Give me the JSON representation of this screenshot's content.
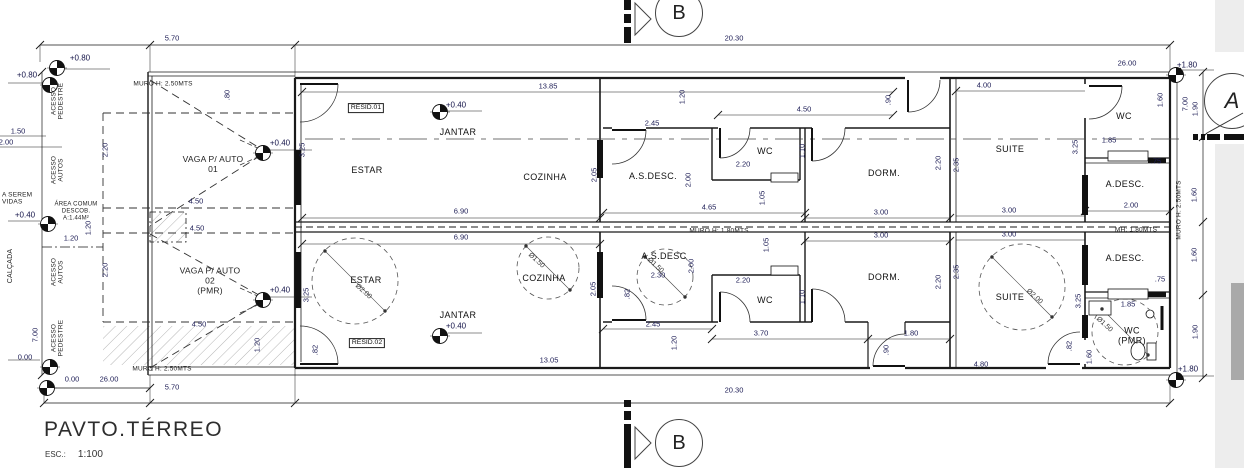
{
  "title_block": {
    "title": "PAVTO.TÉRREO",
    "scale_label": "ESC.:",
    "scale_value": "1:100"
  },
  "section_markers": {
    "top": "B",
    "bottom": "B",
    "side": "A"
  },
  "labels": [
    {
      "t": "ESTAR",
      "x": 367,
      "y": 170,
      "cls": "room"
    },
    {
      "t": "JANTAR",
      "x": 458,
      "y": 132,
      "cls": "room"
    },
    {
      "t": "COZINHA",
      "x": 545,
      "y": 177,
      "cls": "room"
    },
    {
      "t": "A.S.DESC.",
      "x": 653,
      "y": 176,
      "cls": "room"
    },
    {
      "t": "WC",
      "x": 765,
      "y": 151,
      "cls": "room"
    },
    {
      "t": "DORM.",
      "x": 884,
      "y": 173,
      "cls": "room"
    },
    {
      "t": "SUITE",
      "x": 1010,
      "y": 149,
      "cls": "room"
    },
    {
      "t": "WC",
      "x": 1124,
      "y": 116,
      "cls": "room"
    },
    {
      "t": "A.DESC.",
      "x": 1125,
      "y": 184,
      "cls": "room"
    },
    {
      "t": "ESTAR",
      "x": 366,
      "y": 280,
      "cls": "room"
    },
    {
      "t": "JANTAR",
      "x": 458,
      "y": 315,
      "cls": "room"
    },
    {
      "t": "COZINHA",
      "x": 544,
      "y": 278,
      "cls": "room"
    },
    {
      "t": "A.S.DESC",
      "x": 664,
      "y": 256,
      "cls": "room"
    },
    {
      "t": "WC",
      "x": 765,
      "y": 300,
      "cls": "room"
    },
    {
      "t": "DORM.",
      "x": 884,
      "y": 277,
      "cls": "room"
    },
    {
      "t": "SUITE",
      "x": 1010,
      "y": 297,
      "cls": "room"
    },
    {
      "t": "A.DESC.",
      "x": 1125,
      "y": 258,
      "cls": "room"
    },
    {
      "t": "WC\n(PMR)",
      "x": 1132,
      "y": 336,
      "cls": "room"
    },
    {
      "t": "RESID.01",
      "x": 366,
      "y": 108,
      "cls": "boxed",
      "n": "resid-01-tag"
    },
    {
      "t": "RESID.02",
      "x": 367,
      "y": 343,
      "cls": "boxed",
      "n": "resid-02-tag"
    },
    {
      "t": "5.70",
      "x": 172,
      "y": 39
    },
    {
      "t": "20.30",
      "x": 734,
      "y": 39
    },
    {
      "t": "13.85",
      "x": 548,
      "y": 87
    },
    {
      "t": "4.50",
      "x": 804,
      "y": 110
    },
    {
      "t": "4.00",
      "x": 984,
      "y": 86
    },
    {
      "t": "26.00",
      "x": 1127,
      "y": 64
    },
    {
      "t": "2.45",
      "x": 652,
      "y": 124
    },
    {
      "t": "2.20",
      "x": 743,
      "y": 165
    },
    {
      "t": "4.65",
      "x": 709,
      "y": 208
    },
    {
      "t": "6.90",
      "x": 461,
      "y": 212
    },
    {
      "t": "3.00",
      "x": 881,
      "y": 213
    },
    {
      "t": "3.00",
      "x": 1009,
      "y": 211
    },
    {
      "t": "1.85",
      "x": 1109,
      "y": 141
    },
    {
      "t": ".75",
      "x": 1156,
      "y": 162
    },
    {
      "t": "2.00",
      "x": 1131,
      "y": 206
    },
    {
      "t": "6.90",
      "x": 461,
      "y": 238
    },
    {
      "t": "3.00",
      "x": 881,
      "y": 236
    },
    {
      "t": "3.00",
      "x": 1009,
      "y": 235
    },
    {
      "t": "2.30",
      "x": 658,
      "y": 276
    },
    {
      "t": "2.20",
      "x": 743,
      "y": 281
    },
    {
      "t": "2.45",
      "x": 653,
      "y": 325
    },
    {
      "t": "3.70",
      "x": 761,
      "y": 334
    },
    {
      "t": "1.80",
      "x": 911,
      "y": 334
    },
    {
      "t": "1.85",
      "x": 1128,
      "y": 305
    },
    {
      "t": ".75",
      "x": 1160,
      "y": 280
    },
    {
      "t": "4.80",
      "x": 981,
      "y": 365
    },
    {
      "t": "13.05",
      "x": 549,
      "y": 361
    },
    {
      "t": "20.30",
      "x": 734,
      "y": 391
    },
    {
      "t": "5.70",
      "x": 172,
      "y": 388
    },
    {
      "t": "26.00",
      "x": 109,
      "y": 380
    },
    {
      "t": "0.00",
      "x": 72,
      "y": 380
    },
    {
      "t": "0.00",
      "x": 25,
      "y": 358
    },
    {
      "t": "1.50",
      "x": 18,
      "y": 132
    },
    {
      "t": "2.00",
      "x": 6,
      "y": 143
    },
    {
      "t": "4.50",
      "x": 196,
      "y": 202
    },
    {
      "t": "4.50",
      "x": 197,
      "y": 229
    },
    {
      "t": "4.50",
      "x": 199,
      "y": 325
    },
    {
      "t": "1.20",
      "x": 71,
      "y": 239
    },
    {
      "t": ".80",
      "x": 228,
      "y": 95,
      "rot": "v"
    },
    {
      "t": "1.20",
      "x": 683,
      "y": 97,
      "rot": "v"
    },
    {
      "t": ".90",
      "x": 889,
      "y": 100,
      "rot": "v"
    },
    {
      "t": "3.25",
      "x": 303,
      "y": 150,
      "rot": "v"
    },
    {
      "t": "2.05",
      "x": 595,
      "y": 175,
      "rot": "v"
    },
    {
      "t": "2.00",
      "x": 689,
      "y": 180,
      "rot": "v"
    },
    {
      "t": "1.10",
      "x": 803,
      "y": 151,
      "rot": "v"
    },
    {
      "t": "1.05",
      "x": 763,
      "y": 198,
      "rot": "v"
    },
    {
      "t": "2.20",
      "x": 939,
      "y": 163,
      "rot": "v"
    },
    {
      "t": "2.35",
      "x": 957,
      "y": 165,
      "rot": "v"
    },
    {
      "t": "1.60",
      "x": 1161,
      "y": 100,
      "rot": "v"
    },
    {
      "t": "7.00",
      "x": 1186,
      "y": 104,
      "rot": "v"
    },
    {
      "t": "1.90",
      "x": 1196,
      "y": 109,
      "rot": "v"
    },
    {
      "t": "3.25",
      "x": 1076,
      "y": 147,
      "rot": "v"
    },
    {
      "t": "1.60",
      "x": 1195,
      "y": 195,
      "rot": "v"
    },
    {
      "t": "3.25",
      "x": 307,
      "y": 295,
      "rot": "v"
    },
    {
      "t": "2.05",
      "x": 594,
      "y": 289,
      "rot": "v"
    },
    {
      "t": "2.00",
      "x": 692,
      "y": 266,
      "rot": "v"
    },
    {
      "t": "1.05",
      "x": 767,
      "y": 245,
      "rot": "v"
    },
    {
      "t": "1.10",
      "x": 803,
      "y": 297,
      "rot": "v"
    },
    {
      "t": "2.20",
      "x": 939,
      "y": 282,
      "rot": "v"
    },
    {
      "t": "2.35",
      "x": 957,
      "y": 272,
      "rot": "v"
    },
    {
      "t": ".82",
      "x": 628,
      "y": 294,
      "rot": "v"
    },
    {
      "t": "1.20",
      "x": 675,
      "y": 343,
      "rot": "v"
    },
    {
      "t": ".90",
      "x": 887,
      "y": 350,
      "rot": "v"
    },
    {
      "t": "3.25",
      "x": 1079,
      "y": 301,
      "rot": "v"
    },
    {
      "t": "1.60",
      "x": 1195,
      "y": 255,
      "rot": "v"
    },
    {
      "t": "1.90",
      "x": 1196,
      "y": 332,
      "rot": "v"
    },
    {
      "t": "1.60",
      "x": 1090,
      "y": 357,
      "rot": "v"
    },
    {
      "t": ".82",
      "x": 1070,
      "y": 346,
      "rot": "v"
    },
    {
      "t": ".82",
      "x": 316,
      "y": 350,
      "rot": "v"
    },
    {
      "t": "2.20",
      "x": 106,
      "y": 150,
      "rot": "v"
    },
    {
      "t": "2.20",
      "x": 106,
      "y": 270,
      "rot": "v"
    },
    {
      "t": "7.00",
      "x": 36,
      "y": 335,
      "rot": "v"
    },
    {
      "t": "1.20",
      "x": 89,
      "y": 228,
      "rot": "v"
    },
    {
      "t": "1.20",
      "x": 258,
      "y": 345,
      "rot": "v"
    },
    {
      "t": "+0.80",
      "x": 80,
      "y": 58,
      "cls": "lvl"
    },
    {
      "t": "+0.80",
      "x": 27,
      "y": 75,
      "cls": "lvl"
    },
    {
      "t": "+0.40",
      "x": 456,
      "y": 105,
      "cls": "lvl"
    },
    {
      "t": "+0.40",
      "x": 280,
      "y": 143,
      "cls": "lvl"
    },
    {
      "t": "+0.40",
      "x": 25,
      "y": 215,
      "cls": "lvl"
    },
    {
      "t": "+0.40",
      "x": 280,
      "y": 290,
      "cls": "lvl"
    },
    {
      "t": "+0.40",
      "x": 456,
      "y": 326,
      "cls": "lvl"
    },
    {
      "t": "+1.80",
      "x": 1187,
      "y": 65,
      "cls": "lvl"
    },
    {
      "t": "+1.80",
      "x": 1188,
      "y": 369,
      "cls": "lvl"
    },
    {
      "t": "MURO H: 2.50MTS",
      "x": 163,
      "y": 84,
      "cls": "note"
    },
    {
      "t": "MURO H: 1.80MTS",
      "x": 719,
      "y": 231,
      "cls": "note"
    },
    {
      "t": "MH: 1.80MTS",
      "x": 1136,
      "y": 230,
      "cls": "note"
    },
    {
      "t": "MURO H: 2.50MTS",
      "x": 162,
      "y": 369,
      "cls": "note"
    },
    {
      "t": "MURO H: 2.50MTS",
      "x": 1179,
      "y": 210,
      "cls": "note",
      "rot": "v"
    },
    {
      "t": "ACESSO\nPEDESTRE",
      "x": 58,
      "y": 101,
      "cls": "note",
      "rot": "v"
    },
    {
      "t": "ACESSO\nAUTOS",
      "x": 58,
      "y": 170,
      "cls": "note",
      "rot": "v"
    },
    {
      "t": "ACESSO\nAUTOS",
      "x": 58,
      "y": 272,
      "cls": "note",
      "rot": "v"
    },
    {
      "t": "ACESSO\nPEDESTRE",
      "x": 58,
      "y": 338,
      "cls": "note",
      "rot": "v"
    },
    {
      "t": "CALÇADA",
      "x": 11,
      "y": 266,
      "cls": "note",
      "rot": "v",
      "fs": 7
    },
    {
      "t": "VAGA P/ AUTO\n01",
      "x": 213,
      "y": 165,
      "cls": "note",
      "fs": 8.5
    },
    {
      "t": "VAGA P/ AUTO\n02\n(PMR)",
      "x": 210,
      "y": 281,
      "cls": "note",
      "fs": 8.5
    },
    {
      "t": "ÁREA COMUM\nDESCOB.\nA:1.44M²",
      "x": 76,
      "y": 212,
      "cls": "note",
      "fs": 6
    },
    {
      "t": "A SEREM\nVIDAS",
      "x": 2,
      "y": 199,
      "cls": "note",
      "align": "left"
    },
    {
      "t": "Ø2.00",
      "x": 363,
      "y": 292,
      "cls": "dia",
      "rot": 42
    },
    {
      "t": "Ø1.50",
      "x": 536,
      "y": 261,
      "cls": "dia",
      "rot": 42
    },
    {
      "t": "Ø1.50",
      "x": 655,
      "y": 266,
      "cls": "dia",
      "rot": 42
    },
    {
      "t": "Ø2.00",
      "x": 1034,
      "y": 297,
      "cls": "dia",
      "rot": 42
    },
    {
      "t": "Ø1.50",
      "x": 1104,
      "y": 325,
      "cls": "dia",
      "rot": 42
    }
  ]
}
